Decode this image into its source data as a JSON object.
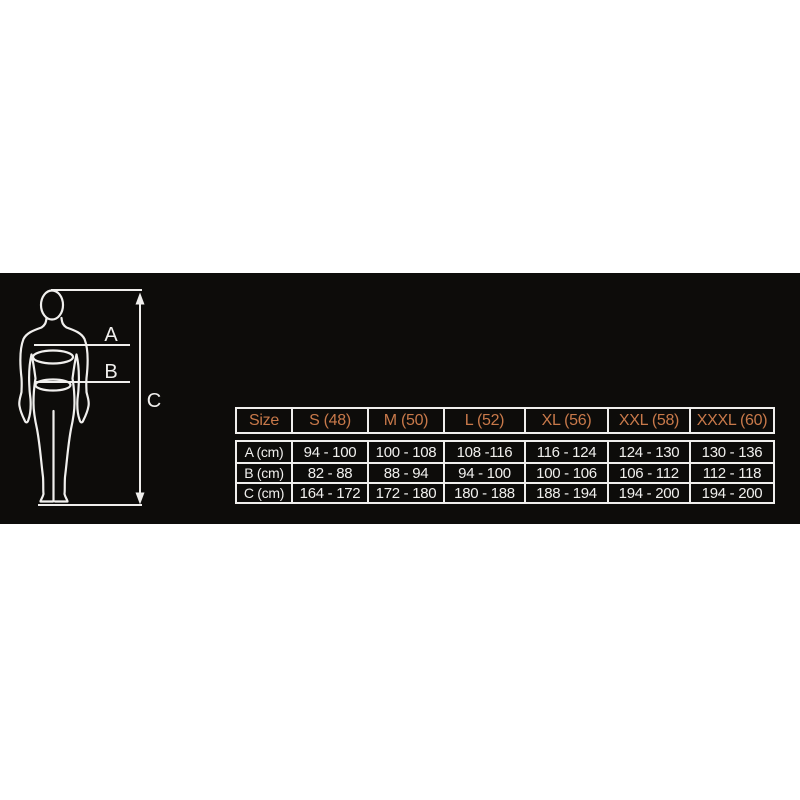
{
  "panel": {
    "background": "#0d0c0a",
    "line_color": "#f0efed"
  },
  "diagram": {
    "labels": {
      "a": "A",
      "b": "B",
      "c": "C"
    }
  },
  "table": {
    "header": [
      "Size",
      "S (48)",
      "M (50)",
      "L (52)",
      "XL (56)",
      "XXL (58)",
      "XXXL (60)"
    ],
    "rows": [
      {
        "label": "A (cm)",
        "values": [
          "94 - 100",
          "100 - 108",
          "108 -116",
          "116 - 124",
          "124 - 130",
          "130 - 136"
        ]
      },
      {
        "label": "B (cm)",
        "values": [
          "82 - 88",
          "88 - 94",
          "94 - 100",
          "100 - 106",
          "106 - 112",
          "112 - 118"
        ]
      },
      {
        "label": "C (cm)",
        "values": [
          "164 - 172",
          "172 - 180",
          "180 - 188",
          "188 - 194",
          "194 - 200",
          "194 - 200"
        ]
      }
    ],
    "colors": {
      "header_text": "#c8794a",
      "cell_text": "#f0efed",
      "border": "#f0efed",
      "background": "#0d0c0a"
    }
  }
}
